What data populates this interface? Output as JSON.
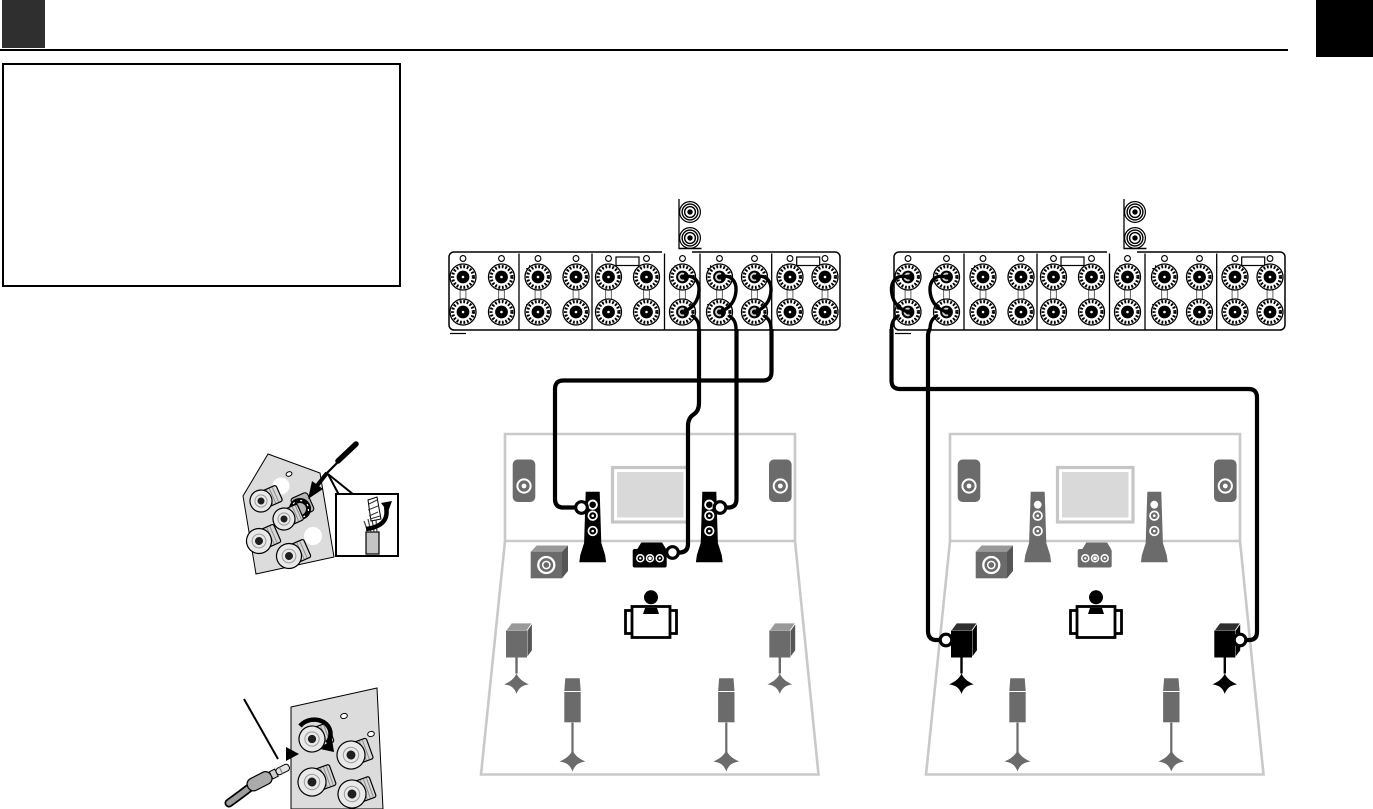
{
  "page": {
    "width": 1373,
    "height": 809,
    "background": "#ffffff",
    "header": {
      "left_tab_color": "#2f2f2f",
      "right_tab_color": "#000000",
      "rule_color": "#000000"
    },
    "note_box": {
      "border_color": "#000000",
      "content": ""
    }
  },
  "colors": {
    "line_black": "#000000",
    "speaker_gray": "#6b6b6b",
    "speaker_gray_top": "#999999",
    "speaker_gray_side": "#565656",
    "speaker_black": "#000000",
    "speaker_black_top": "#2f2f2f",
    "room_outline": "#c9c9c9",
    "tv_fill": "#d9d9d9",
    "tv_frame": "#c6c6c6",
    "illustration_panel": "#dcdcdc",
    "cable": "#000000"
  },
  "speaker_panel_template": {
    "y": 252,
    "width": 391,
    "height": 78,
    "top_row_y": 277,
    "bottom_row_y": 312,
    "columns_x": [
      14,
      52.5,
      89,
      127,
      159.5,
      197.5,
      233.5,
      270.5,
      305.5,
      341,
      376
    ],
    "dividers_x": [
      70,
      143,
      215.5,
      251,
      322.7
    ],
    "groups": [
      {
        "plus_x": 4
      },
      {
        "plus_x": 76
      },
      {
        "plus_x": 149,
        "label_box_x": 167
      },
      {
        "plus_x": 221.5
      },
      {
        "plus_x": 257
      },
      {
        "plus_x": 329,
        "label_box_x": 347.7
      }
    ],
    "label_box": {
      "y": 257,
      "width": 23,
      "height": 8.5
    },
    "plus_label": "+",
    "minus_label": "−",
    "pre_out": {
      "line_x": 230,
      "jack_cx": 241,
      "jack_cy_top": 212,
      "jack_cy_bottom": 238,
      "underline_y": 248.5
    }
  },
  "speaker_panels": [
    {
      "id": "left",
      "x": 449,
      "connected_columns": [
        6,
        7,
        8
      ],
      "loop_side": "right"
    },
    {
      "id": "right",
      "x": 894,
      "connected_columns": [
        0,
        1
      ],
      "loop_side": "left"
    }
  ],
  "rooms": [
    {
      "id": "left",
      "dx": 0,
      "speakers": {
        "presence_left": "gray",
        "presence_right": "gray",
        "front_left": "black",
        "front_right": "black",
        "center": "black",
        "subwoofer": "gray",
        "surround_left": "gray",
        "surround_right": "gray",
        "surround_back_left": "gray",
        "surround_back_right": "gray"
      },
      "connected": [
        "front_left",
        "front_right",
        "center"
      ]
    },
    {
      "id": "right",
      "dx": 445,
      "speakers": {
        "presence_left": "gray",
        "presence_right": "gray",
        "front_left": "gray",
        "front_right": "gray",
        "center": "gray",
        "subwoofer": "gray",
        "surround_left": "black",
        "surround_right": "black",
        "surround_back_left": "gray",
        "surround_back_right": "gray"
      },
      "connected": [
        "surround_left",
        "surround_right"
      ]
    }
  ],
  "illustrations": [
    {
      "id": "wire-to-binding-post",
      "icons": [
        "binding-posts",
        "speaker-wire",
        "insert-arrow",
        "callout-bubble",
        "stripped-wire",
        "twist-arrow"
      ]
    },
    {
      "id": "banana-plug",
      "icons": [
        "binding-posts",
        "banana-plug",
        "insert-arrow",
        "rotate-arrow"
      ]
    }
  ]
}
